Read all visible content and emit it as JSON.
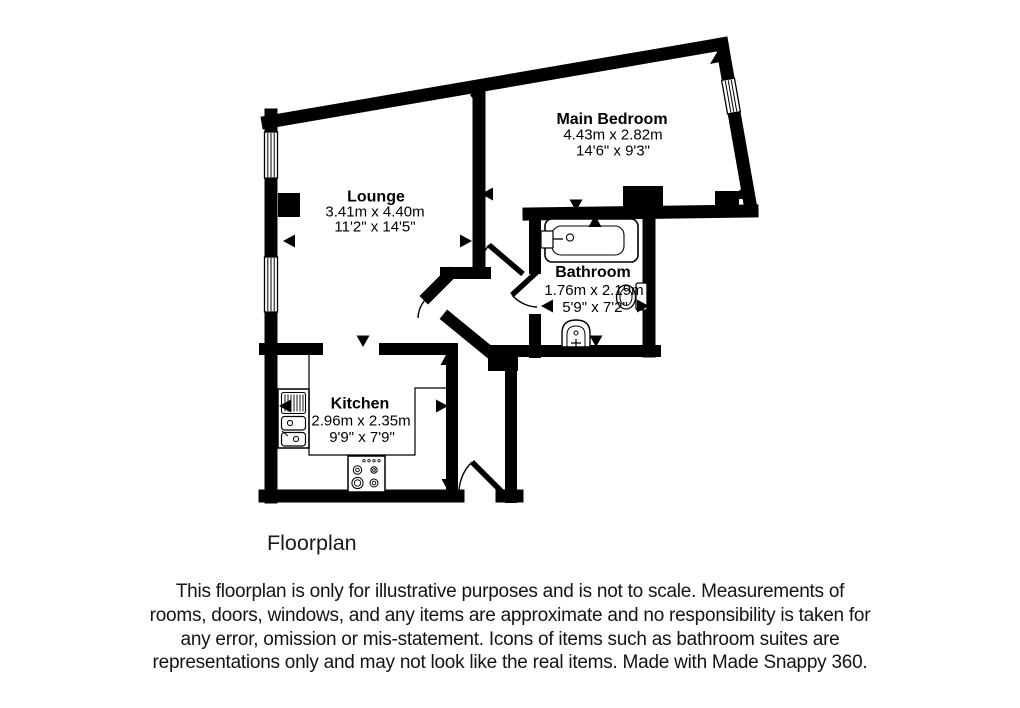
{
  "page": {
    "background": "#ffffff",
    "line_color": "#000000",
    "text_color": "#1a1a1a"
  },
  "plan": {
    "rooms": [
      {
        "id": "lounge",
        "name": "Lounge",
        "size_metric": "3.41m x 4.40m",
        "size_imperial": "11'2\" x 14'5\""
      },
      {
        "id": "main-bedroom",
        "name": "Main Bedroom",
        "size_metric": "4.43m x 2.82m",
        "size_imperial": "14'6\" x 9'3\""
      },
      {
        "id": "bathroom",
        "name": "Bathroom",
        "size_metric": "1.76m x 2.19m",
        "size_imperial": "5'9\" x 7'2\""
      },
      {
        "id": "kitchen",
        "name": "Kitchen",
        "size_metric": "2.96m x 2.35m",
        "size_imperial": "9'9\" x 7'9\""
      }
    ],
    "fixtures": [
      {
        "id": "bath",
        "room": "bathroom"
      },
      {
        "id": "toilet",
        "room": "bathroom"
      },
      {
        "id": "wash-basin",
        "room": "bathroom"
      },
      {
        "id": "sink-drainer-unit",
        "room": "kitchen"
      },
      {
        "id": "hob",
        "room": "kitchen"
      }
    ],
    "windows": [
      {
        "room": "lounge",
        "wall": "left",
        "position": "upper"
      },
      {
        "room": "lounge",
        "wall": "left",
        "position": "lower"
      },
      {
        "room": "main-bedroom",
        "wall": "right",
        "position": "upper"
      }
    ],
    "doors": [
      {
        "from": "hall",
        "to": "lounge"
      },
      {
        "from": "hall",
        "to": "main-bedroom"
      },
      {
        "from": "hall",
        "to": "bathroom"
      },
      {
        "from": "outside",
        "to": "hall",
        "type": "entrance"
      },
      {
        "from": "lounge",
        "to": "kitchen",
        "type": "open-doorway"
      }
    ],
    "measurement_arrows": [
      {
        "room": "lounge",
        "direction": "left"
      },
      {
        "room": "lounge",
        "direction": "right"
      },
      {
        "room": "lounge",
        "direction": "down"
      },
      {
        "room": "main-bedroom",
        "direction": "left"
      },
      {
        "room": "main-bedroom",
        "direction": "down"
      },
      {
        "room": "bathroom",
        "direction": "up"
      },
      {
        "room": "bathroom",
        "direction": "down"
      },
      {
        "room": "bathroom",
        "direction": "left"
      },
      {
        "room": "bathroom",
        "direction": "right"
      },
      {
        "room": "kitchen",
        "direction": "left"
      },
      {
        "room": "kitchen",
        "direction": "right"
      },
      {
        "room": "kitchen",
        "direction": "up"
      },
      {
        "room": "kitchen",
        "direction": "down"
      }
    ]
  },
  "footer": {
    "label": "Floorplan",
    "disclaimer": "This floorplan is only for illustrative purposes and is not to scale. Measurements of rooms, doors, windows, and any items are approximate and no responsibility is taken for any error, omission or mis-statement. Icons of items such as bathroom suites are representations only and may not look like the real items. Made with Made Snappy 360."
  }
}
